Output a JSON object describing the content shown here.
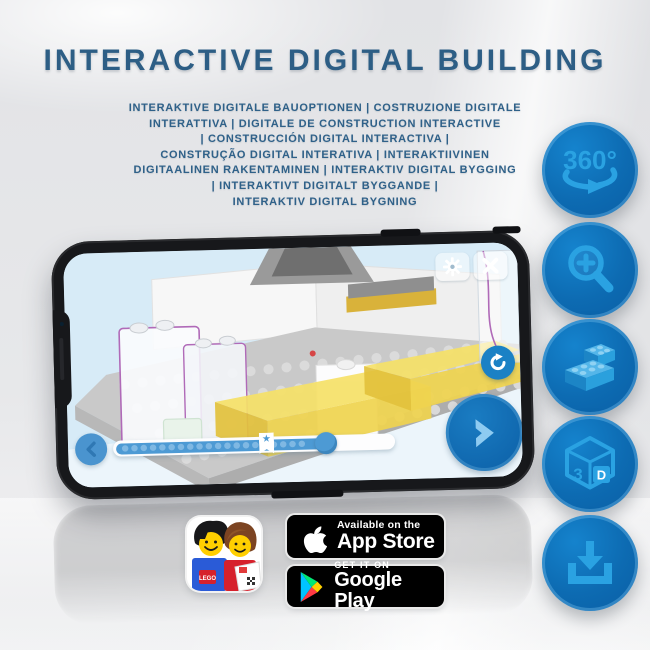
{
  "header": {
    "title": "INTERACTIVE DIGITAL BUILDING",
    "subtitle_lines": [
      "INTERAKTIVE DIGITALE BAUOPTIONEN | COSTRUZIONE DIGITALE",
      "INTERATTIVA | DIGITALE DE CONSTRUCTION INTERACTIVE",
      "| CONSTRUCCIÓN DIGITAL INTERACTIVA |",
      "CONSTRUÇÃO DIGITAL INTERATIVA | INTERAKTIIVINEN",
      "DIGITAALINEN RAKENTAMINEN | INTERAKTIV DIGITAL BYGGING",
      "| INTERAKTIVT DIGITALT BYGGANDE |",
      "INTERAKTIV DIGITAL BYGNING"
    ]
  },
  "features": [
    {
      "icon": "rotate-360-icon",
      "label": "360°"
    },
    {
      "icon": "zoom-in-icon"
    },
    {
      "icon": "lego-brick-icon"
    },
    {
      "icon": "cube-3d-icon",
      "label_left": "3",
      "label_right": "D"
    },
    {
      "icon": "download-icon"
    }
  ],
  "phone_app": {
    "controls": {
      "settings": "gear",
      "close": "x",
      "rotate_view": "refresh-arrow",
      "next_step": "chevron-right",
      "previous_step": "chevron-left"
    },
    "progress": {
      "total_dots": 22,
      "star_position_pct": 54,
      "handle_position_pct": 76
    }
  },
  "app_icon": {
    "lego_logo_text": "LEGO"
  },
  "store_badges": {
    "app_store": {
      "tagline": "Available on the",
      "name": "App Store"
    },
    "google_play": {
      "tagline": "GET IT ON",
      "name": "Google Play"
    }
  },
  "colors": {
    "title_blue": "#2d5e85",
    "circle_blue": "#0d6bb2",
    "icon_light_blue": "#2aa2e2",
    "screen_sky": "#d7ebf7",
    "slider_blue": "#4d9ad4",
    "brick_yellow": "#f2d94f",
    "outline_purple": "#b06ab8"
  }
}
